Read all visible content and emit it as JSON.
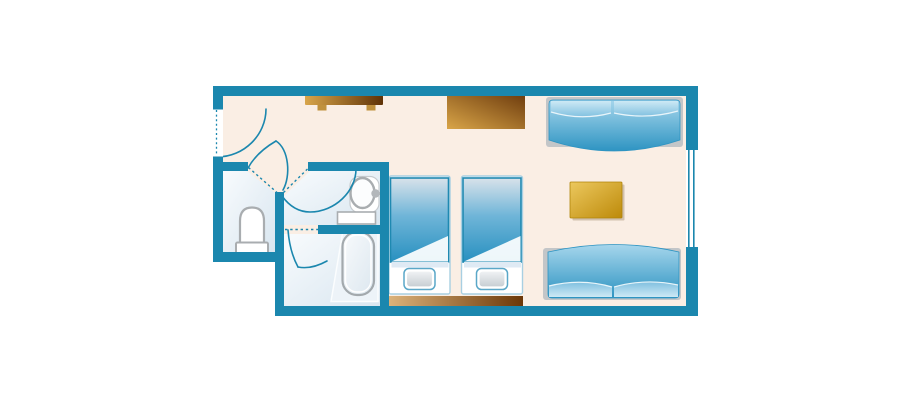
{
  "plan": {
    "kind": "hotel-room-floor-plan",
    "rooms": [
      {
        "id": "entry",
        "label": "entry",
        "features": [
          "entrance-door",
          "door-swing"
        ]
      },
      {
        "id": "toilet-room",
        "label": "toilet room",
        "fixtures": [
          "toilet-bowl",
          "toilet-tank"
        ]
      },
      {
        "id": "washroom",
        "label": "washroom",
        "fixtures": [
          "washbasin",
          "faucet",
          "vanity-counter"
        ]
      },
      {
        "id": "bathroom",
        "label": "bathroom",
        "fixtures": [
          "bathtub"
        ]
      },
      {
        "id": "main-room",
        "label": "main room",
        "furniture": [
          "luggage-bench",
          "dresser",
          "twin-bed-1",
          "twin-bed-2",
          "headboard-panel",
          "sofa-bed-top",
          "sofa-bed-bottom",
          "side-table"
        ]
      }
    ],
    "features": [
      "window-right-wall",
      "dashed-door-openings",
      "door-swing-arcs"
    ]
  },
  "colors": {
    "wall": "#1b87ae",
    "floor": "#faeee4",
    "wetLight": "#f8fbfd",
    "wetDark": "#d9e6f0",
    "outlineGray": "#a9adb0",
    "frameGray": "#c3c6c8",
    "duvetBorder": "#1f89b1",
    "twinDuvetTop": "#d8e2ea",
    "twinDuvetMid": "#6fb5d8",
    "twinDuvetBot": "#2890c0",
    "bedLight": "#a6d6ec",
    "bedDark": "#2e94c2",
    "pillowLight": "#cde9f5",
    "pillowMid": "#82c1e0",
    "pillowBorder": "#5aa7c8",
    "pillowFillTop": "#f1f3f5",
    "pillowFillBot": "#c6cdd2",
    "paleBand": "#dfeaf4",
    "woodLight": "#d8a54a",
    "woodDark": "#5f3206",
    "stripLight": "#ddb47c",
    "stripDark": "#6b3708",
    "dresserLight": "#d9a548",
    "dresserDark": "#6f3d0e",
    "goldLight": "#ecc85e",
    "goldDark": "#bd8a0a",
    "legTan": "#c0913d",
    "tubLight": "#f8fafc",
    "tubDark": "#dce7ef"
  }
}
